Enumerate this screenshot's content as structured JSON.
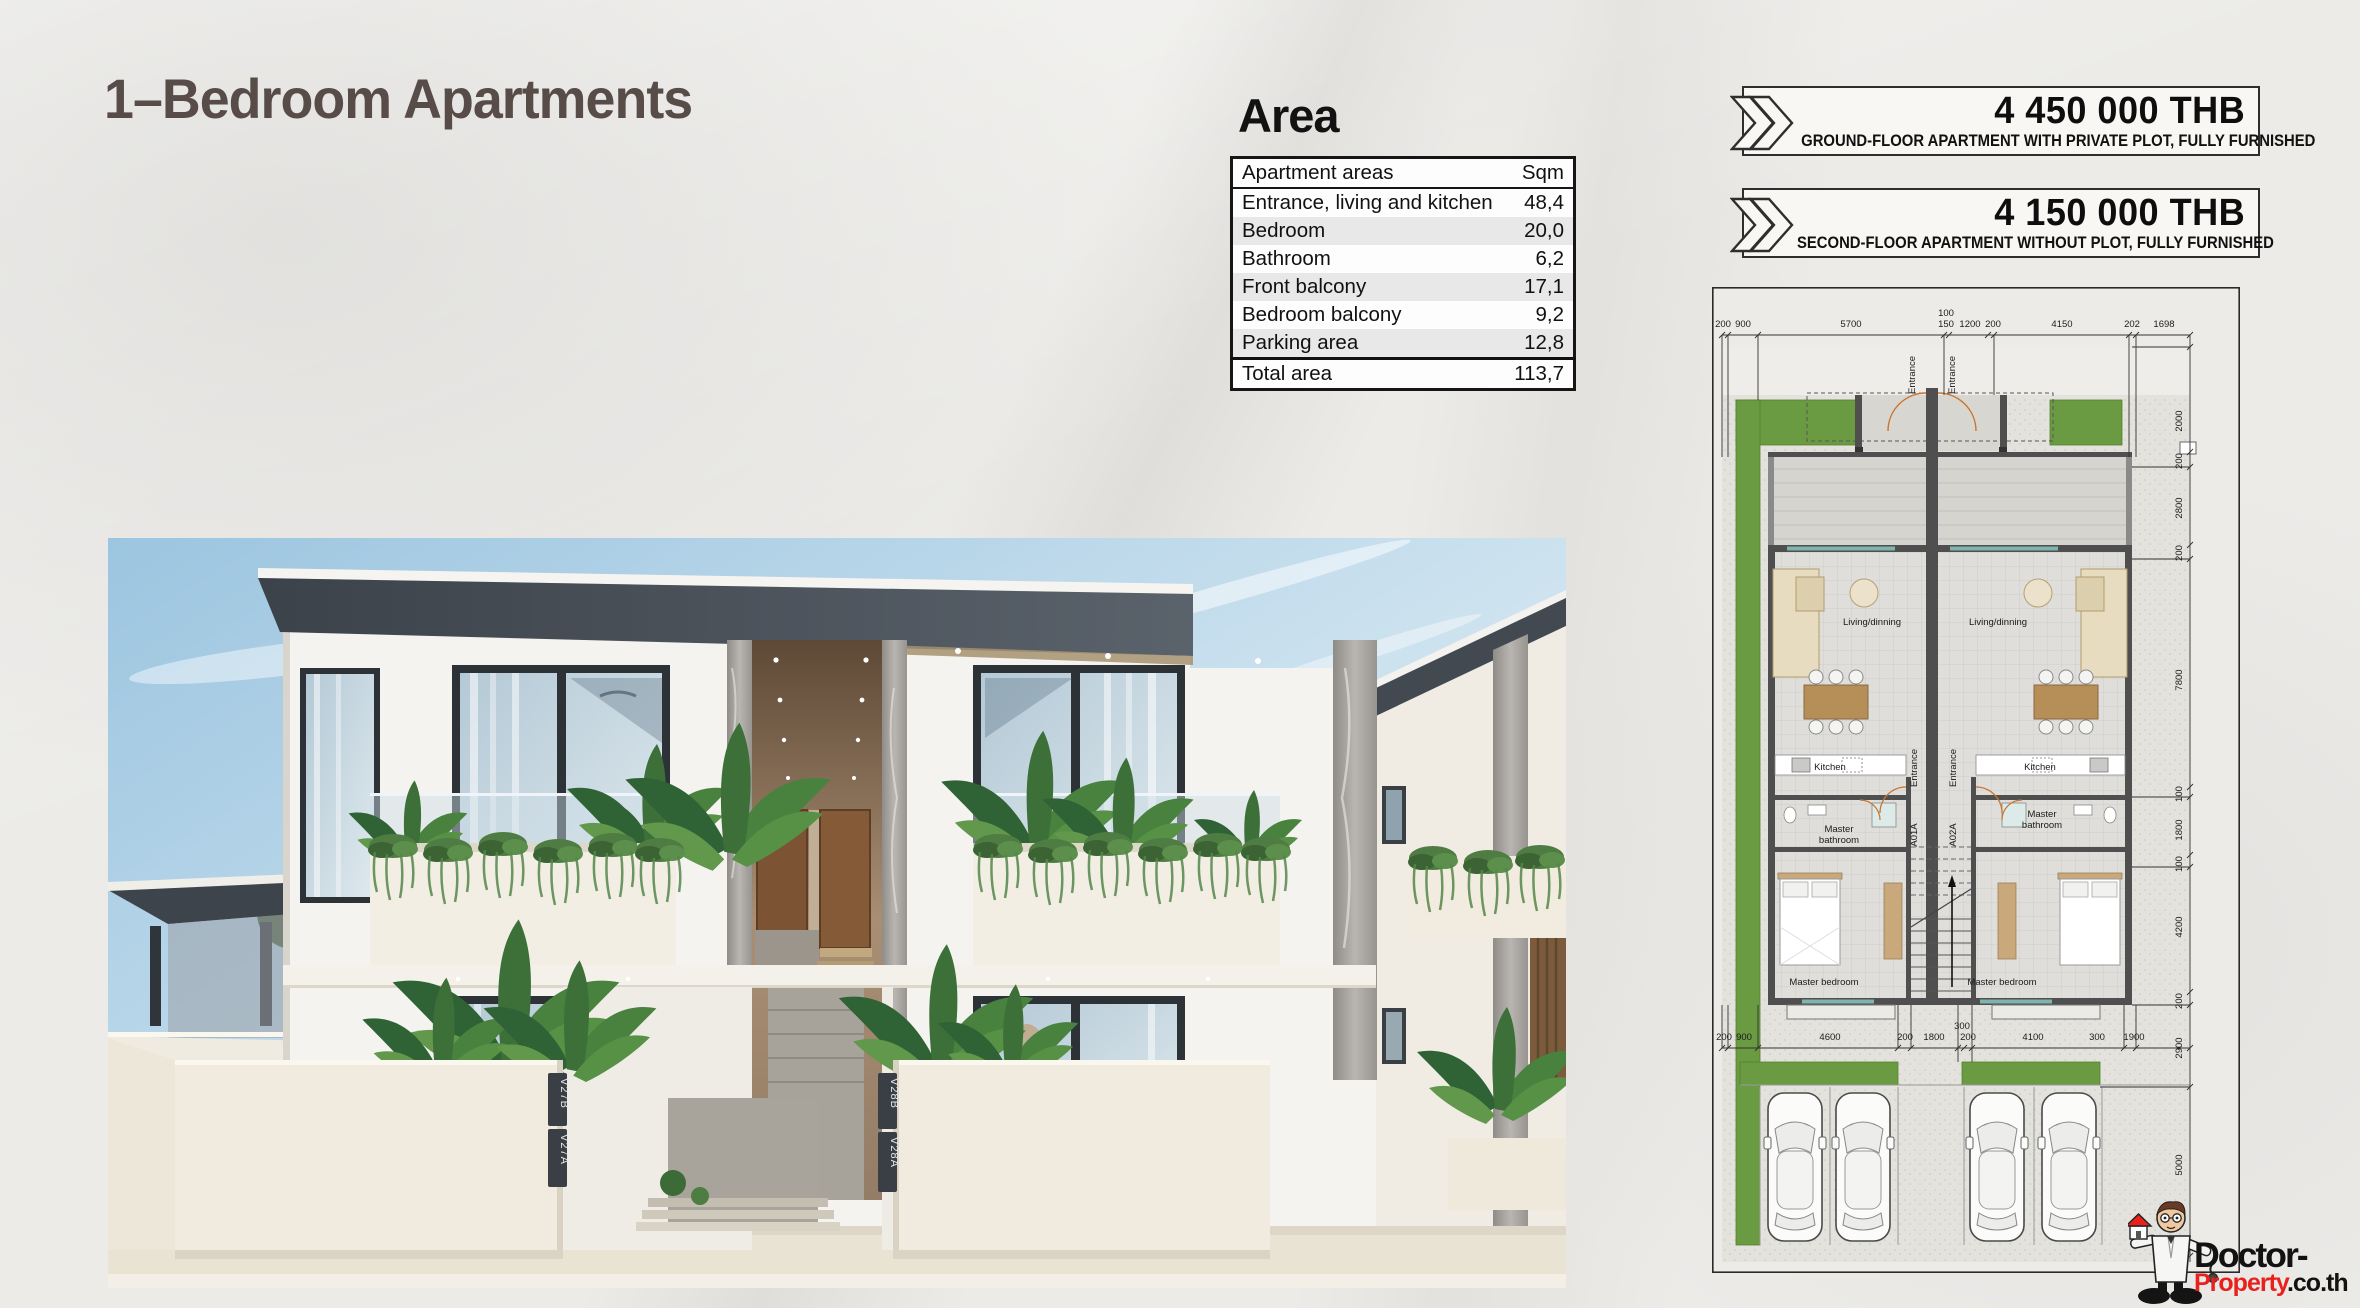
{
  "page": {
    "title": "1–Bedroom Apartments"
  },
  "area": {
    "heading": "Area",
    "columns": {
      "label": "Apartment areas",
      "unit": "Sqm"
    },
    "rows": [
      {
        "label": "Entrance, living and kitchen",
        "value": "48,4"
      },
      {
        "label": "Bedroom",
        "value": "20,0"
      },
      {
        "label": "Bathroom",
        "value": "6,2"
      },
      {
        "label": "Front balcony",
        "value": "17,1"
      },
      {
        "label": "Bedroom balcony",
        "value": "9,2"
      },
      {
        "label": "Parking area",
        "value": "12,8"
      }
    ],
    "total": {
      "label": "Total area",
      "value": "113,7"
    }
  },
  "offers": [
    {
      "price": "4 450 000 THB",
      "description": "GROUND-FLOOR APARTMENT WITH PRIVATE PLOT, FULLY FURNISHED"
    },
    {
      "price": "4 150 000 THB",
      "description": "SECOND-FLOOR APARTMENT WITHOUT PLOT, FULLY FURNISHED"
    }
  ],
  "floor_plan": {
    "rooms": {
      "entrance": "Entrance",
      "living": "Living/dinning",
      "kitchen": "Kitchen",
      "master_line1": "Master",
      "master_line2": "bathroom",
      "bedroom": "Master bedroom",
      "unit_left": "A01A",
      "unit_right": "A02A"
    },
    "dims_top": [
      "200",
      "900",
      "5700",
      "100",
      "150",
      "1200",
      "200",
      "4150",
      "202",
      "1698"
    ],
    "dims_right": [
      "2000",
      "200",
      "2800",
      "200",
      "7800",
      "100",
      "1800",
      "100",
      "4200",
      "200",
      "2900",
      "5000"
    ],
    "dims_bottom": [
      "200",
      "900",
      "4600",
      "200",
      "1800",
      "300",
      "200",
      "4100",
      "300",
      "1900"
    ]
  },
  "render": {
    "unit_signs": [
      "V27B",
      "V27A",
      "V28B",
      "V28A"
    ]
  },
  "logo": {
    "name_top": "Doctor-",
    "name_bottom_red": "Property",
    "name_bottom_suffix": ".co.th"
  },
  "colors": {
    "accent_red": "#e8211d",
    "plan_green": "#6a9a42",
    "roof": "#42484f"
  }
}
